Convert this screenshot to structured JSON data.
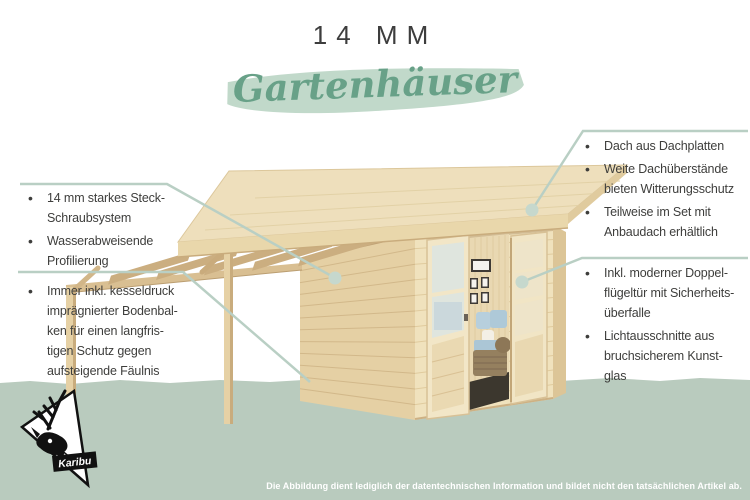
{
  "glyphs": {
    "bullet": "•"
  },
  "header": {
    "thickness_label": "14 MM",
    "category_script": "Gartenhäuser"
  },
  "callouts": {
    "left_top": [
      [
        "14 mm starkes Steck-",
        "Schraubsystem"
      ],
      [
        "Wasserabweisende",
        "Profilierung"
      ]
    ],
    "left_bottom": [
      [
        "Immer inkl. kesseldruck",
        "imprägnierter Bodenbal-",
        "ken für einen langfris-",
        "tigen Schutz gegen",
        "aufsteigende Fäulnis"
      ]
    ],
    "right_top": [
      [
        "Dach aus Dachplatten"
      ],
      [
        "Weite Dachüberstände",
        "bieten Witterungsschutz"
      ],
      [
        "Teilweise im Set mit",
        "Anbaudach erhältlich"
      ]
    ],
    "right_bottom": [
      [
        "Inkl. moderner Doppel-",
        "flügeltür mit Sicherheits-",
        "überfalle"
      ],
      [
        "Lichtausschnitte aus",
        "bruchsicherem Kunst-",
        "glas"
      ]
    ]
  },
  "footer": {
    "disclaimer": "Die Abbildung dient lediglich der datentechnischen Information und bildet nicht den tatsächlichen Artikel ab."
  },
  "logo": {
    "brand": "Karibu"
  },
  "colors": {
    "accent_green": "#68a188",
    "brush_green": "#c1d9ca",
    "ground_green": "#b9cbbe",
    "leader_green": "#b9cfc4",
    "text_dark": "#3e3e3c",
    "wood_light": "#eedfbc",
    "wood_mid": "#e5d0a4",
    "sofa_blue": "#b7cfdd"
  }
}
